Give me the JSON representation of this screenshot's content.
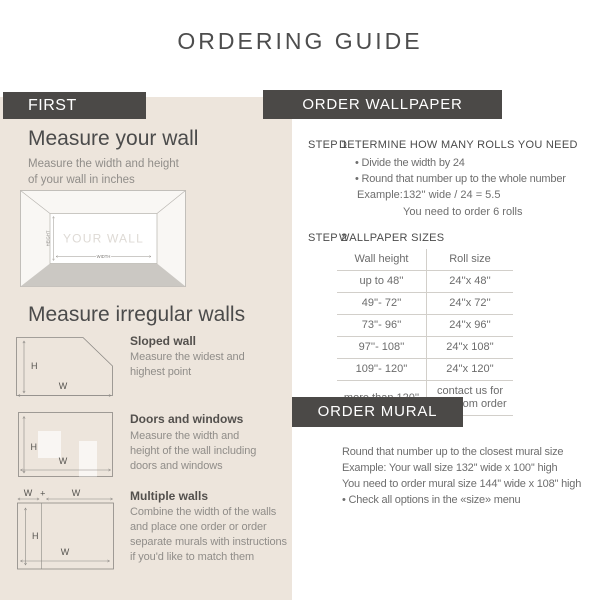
{
  "title": "ORDERING GUIDE",
  "colors": {
    "accent_dark": "#4b4947",
    "panel_beige": "#ede5dc",
    "floor_gray": "#cbc8c3"
  },
  "left_panel": {
    "badge": "FIRST",
    "measure_wall": {
      "heading": "Measure your wall",
      "subtitle_lines": [
        "Measure the width and height",
        "of your wall in inches"
      ],
      "diagram": {
        "wall_text": "YOUR WALL",
        "height_label": "HEIGHT",
        "width_label": "WIDTH"
      }
    },
    "irregular": {
      "heading": "Measure irregular walls",
      "sloped": {
        "title": "Sloped wall",
        "desc_lines": [
          "Measure the widest and",
          "highest point"
        ],
        "h_label": "H",
        "w_label": "W"
      },
      "doors": {
        "title": "Doors and windows",
        "desc_lines": [
          "Measure the width and",
          "height of the wall including",
          "doors and windows"
        ],
        "h_label": "H",
        "w_label": "W"
      },
      "multiple": {
        "title": "Multiple walls",
        "desc_lines": [
          "Combine the width of the walls",
          "and place one order or order",
          "separate murals with instructions",
          "if you'd like to match them"
        ],
        "h_label": "H",
        "w_label": "W",
        "w_top_left": "W",
        "plus": "+",
        "w_top_right": "W"
      }
    }
  },
  "order_wallpaper": {
    "header": "ORDER WALLPAPER",
    "step1": {
      "label": "STEP 1",
      "title": "DETERMINE HOW MANY ROLLS YOU NEED",
      "bullets": [
        "• Divide the width by 24",
        "• Round that number up to the whole number"
      ],
      "example_label": "Example:",
      "example_value": "132'' wide / 24 = 5.5",
      "example_result": "You need to order 6 rolls"
    },
    "step2": {
      "label": "STEP 2",
      "title": "WALLPAPER SIZES",
      "table": {
        "headers": [
          "Wall height",
          "Roll size"
        ],
        "rows": [
          [
            "up to 48''",
            "24''x 48''"
          ],
          [
            "49''- 72''",
            "24''x 72''"
          ],
          [
            "73''- 96''",
            "24''x 96''"
          ],
          [
            "97''- 108''",
            "24''x 108''"
          ],
          [
            "109''- 120''",
            "24''x 120''"
          ],
          [
            "more than 120''",
            "contact us for a custom order"
          ]
        ]
      }
    }
  },
  "order_mural": {
    "header": "ORDER MURAL",
    "lines": [
      "Round that number up to the closest mural size",
      "Example: Your wall size 132'' wide x 100'' high",
      "You need to order mural size 144'' wide x 108'' high",
      "• Check all options in the «size» menu"
    ]
  }
}
